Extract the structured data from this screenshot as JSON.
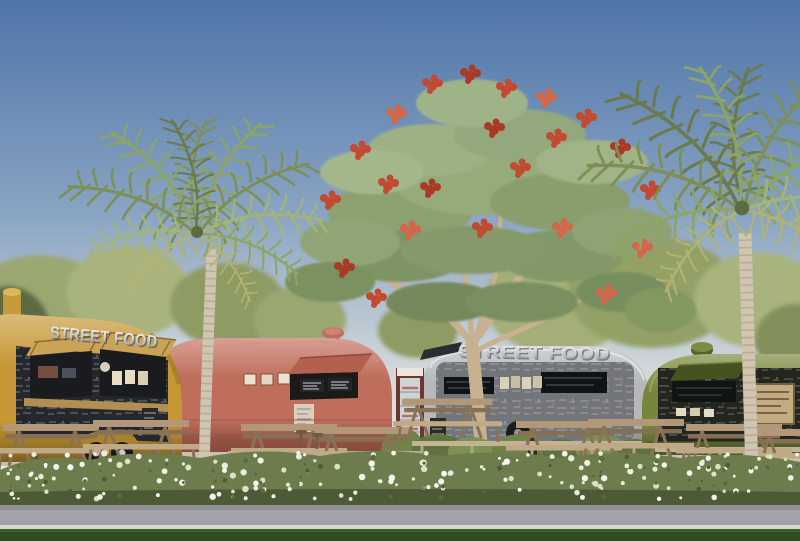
{
  "signs": {
    "yellow_trailer_sign": "STREET FOOD",
    "silver_trailer_sign": "STREET FOOD"
  },
  "palette": {
    "sky_top": "#4e74a8",
    "sky_mid": "#8aa5c3",
    "sky_horizon": "#ecebe4",
    "bg_tree_green": "#9aa771",
    "trailer_yellow": "#c79735",
    "trailer_red": "#c06e5c",
    "trailer_silver": "#b7b8ba",
    "trailer_green": "#76863c",
    "chalkboard": "#24272c",
    "awning_wood": "#c9a458",
    "counter_wood": "#b08e54",
    "vending_red": "#6e3630",
    "table_wood": "#b29878",
    "bench_wood": "#c3b392",
    "canopy_green": "#8ca070",
    "bloom_red": "#c14a30",
    "branch_tan": "#c7b191",
    "palm_green": "#7d8f55",
    "palm_trunk": "#cfc5b0",
    "hedge_green": "#6d7c4c",
    "flower_white": "#f3f4e9",
    "path_gray": "#a2a2a8",
    "curb_white": "#d8d8d0",
    "grass_green": "#2f4d20"
  }
}
